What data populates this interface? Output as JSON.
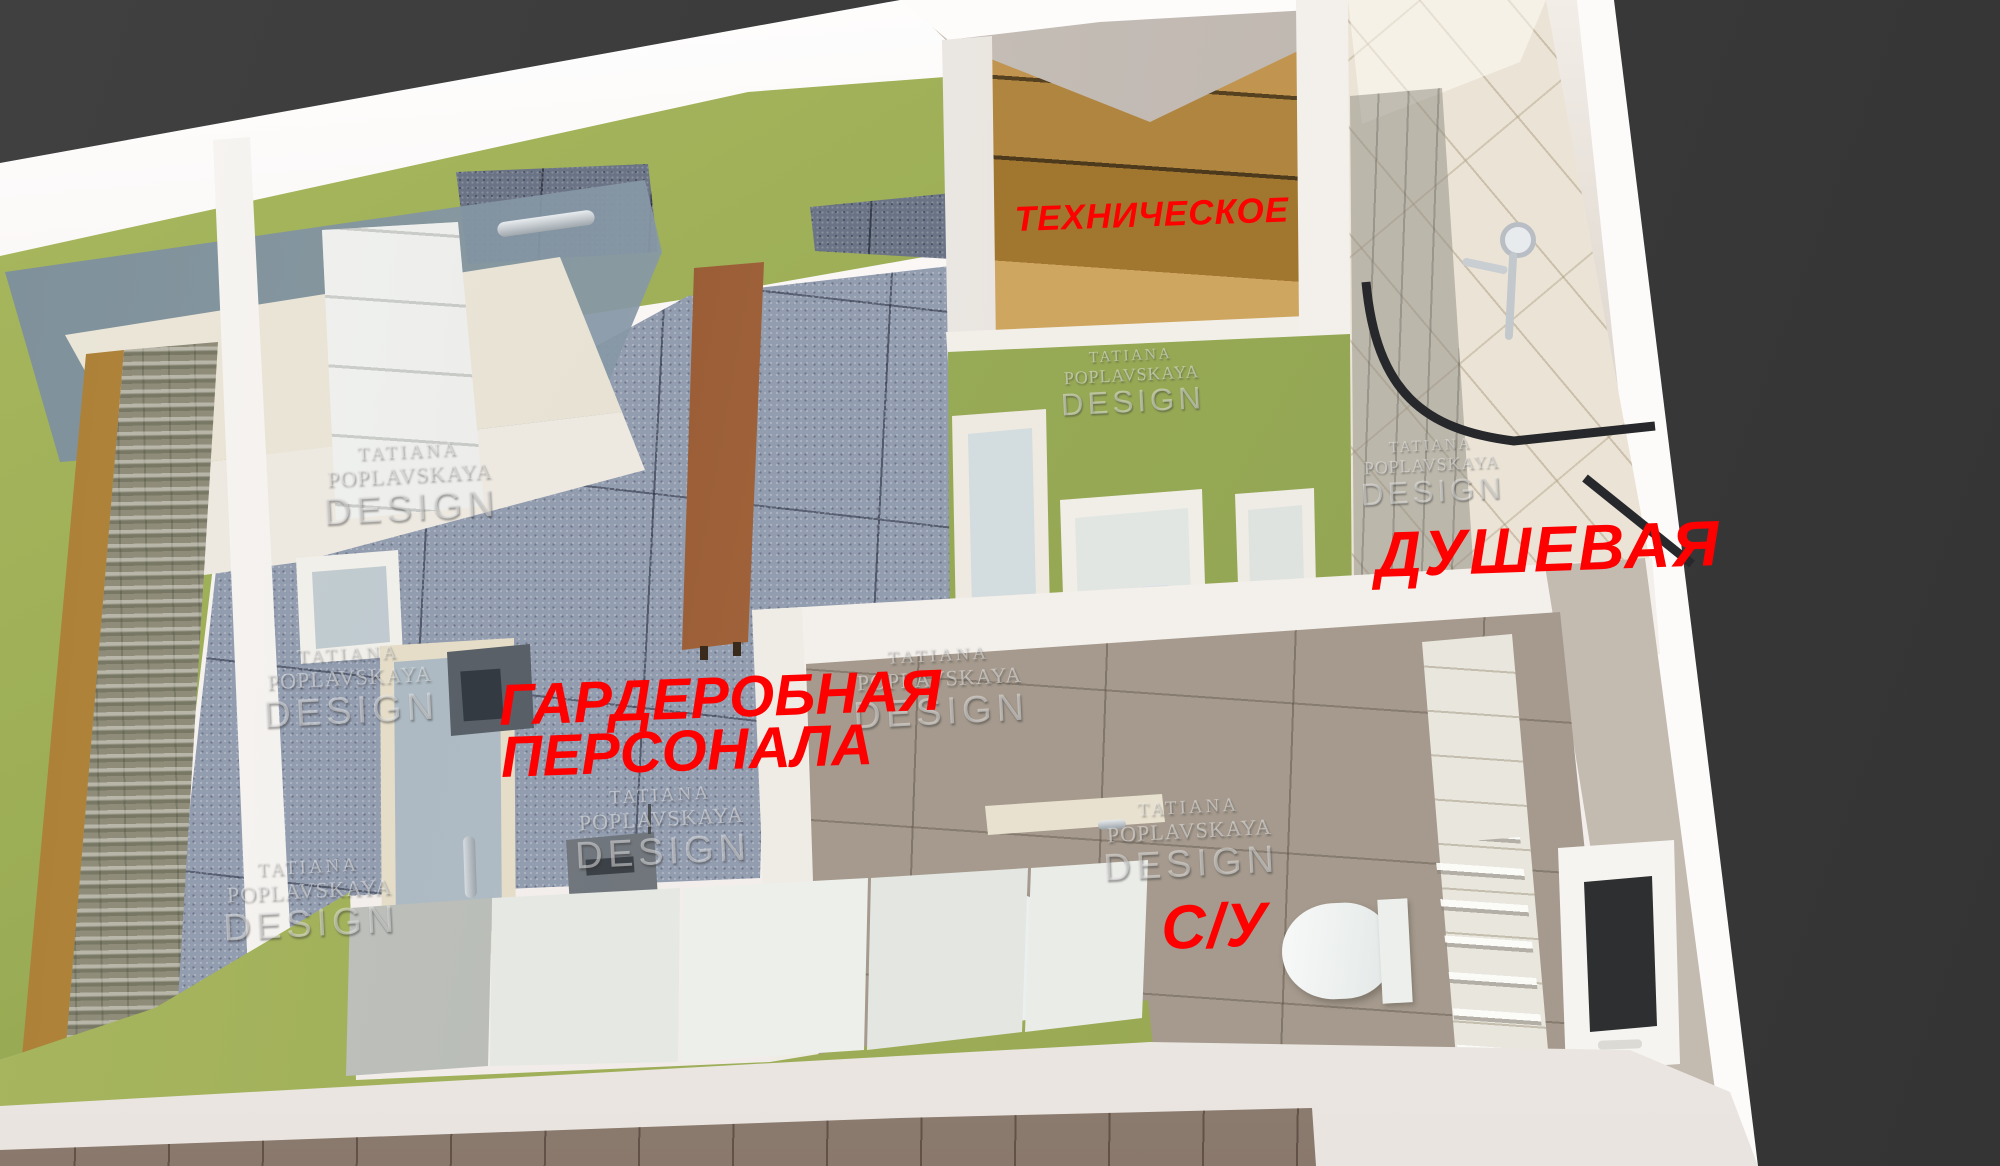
{
  "rooms": {
    "technical": {
      "label": "ТЕХНИЧЕСКОЕ"
    },
    "shower": {
      "label": "ДУШЕВАЯ"
    },
    "staff_wardrobe": {
      "label_line1": "ГАРДЕРОБНАЯ",
      "label_line2": "ПЕРСОНАЛА"
    },
    "wc": {
      "label": "С/У"
    }
  },
  "watermark": {
    "line1": "TATIANA",
    "line2": "POPLAVSKAYA",
    "line3": "DESIGN"
  },
  "colors": {
    "label_red": "#fe0000",
    "wall_green": "#9aac55",
    "tile_floor_gray_blue": "#939db0",
    "shower_tile_beige": "#ebe4d6",
    "wc_floor_taupe": "#a59a8d",
    "stair_wood": "#c19550",
    "bench_leather_rust": "#9c5c39",
    "walls_white": "#f6f3f0",
    "background_dark": "#3b3b3b"
  }
}
